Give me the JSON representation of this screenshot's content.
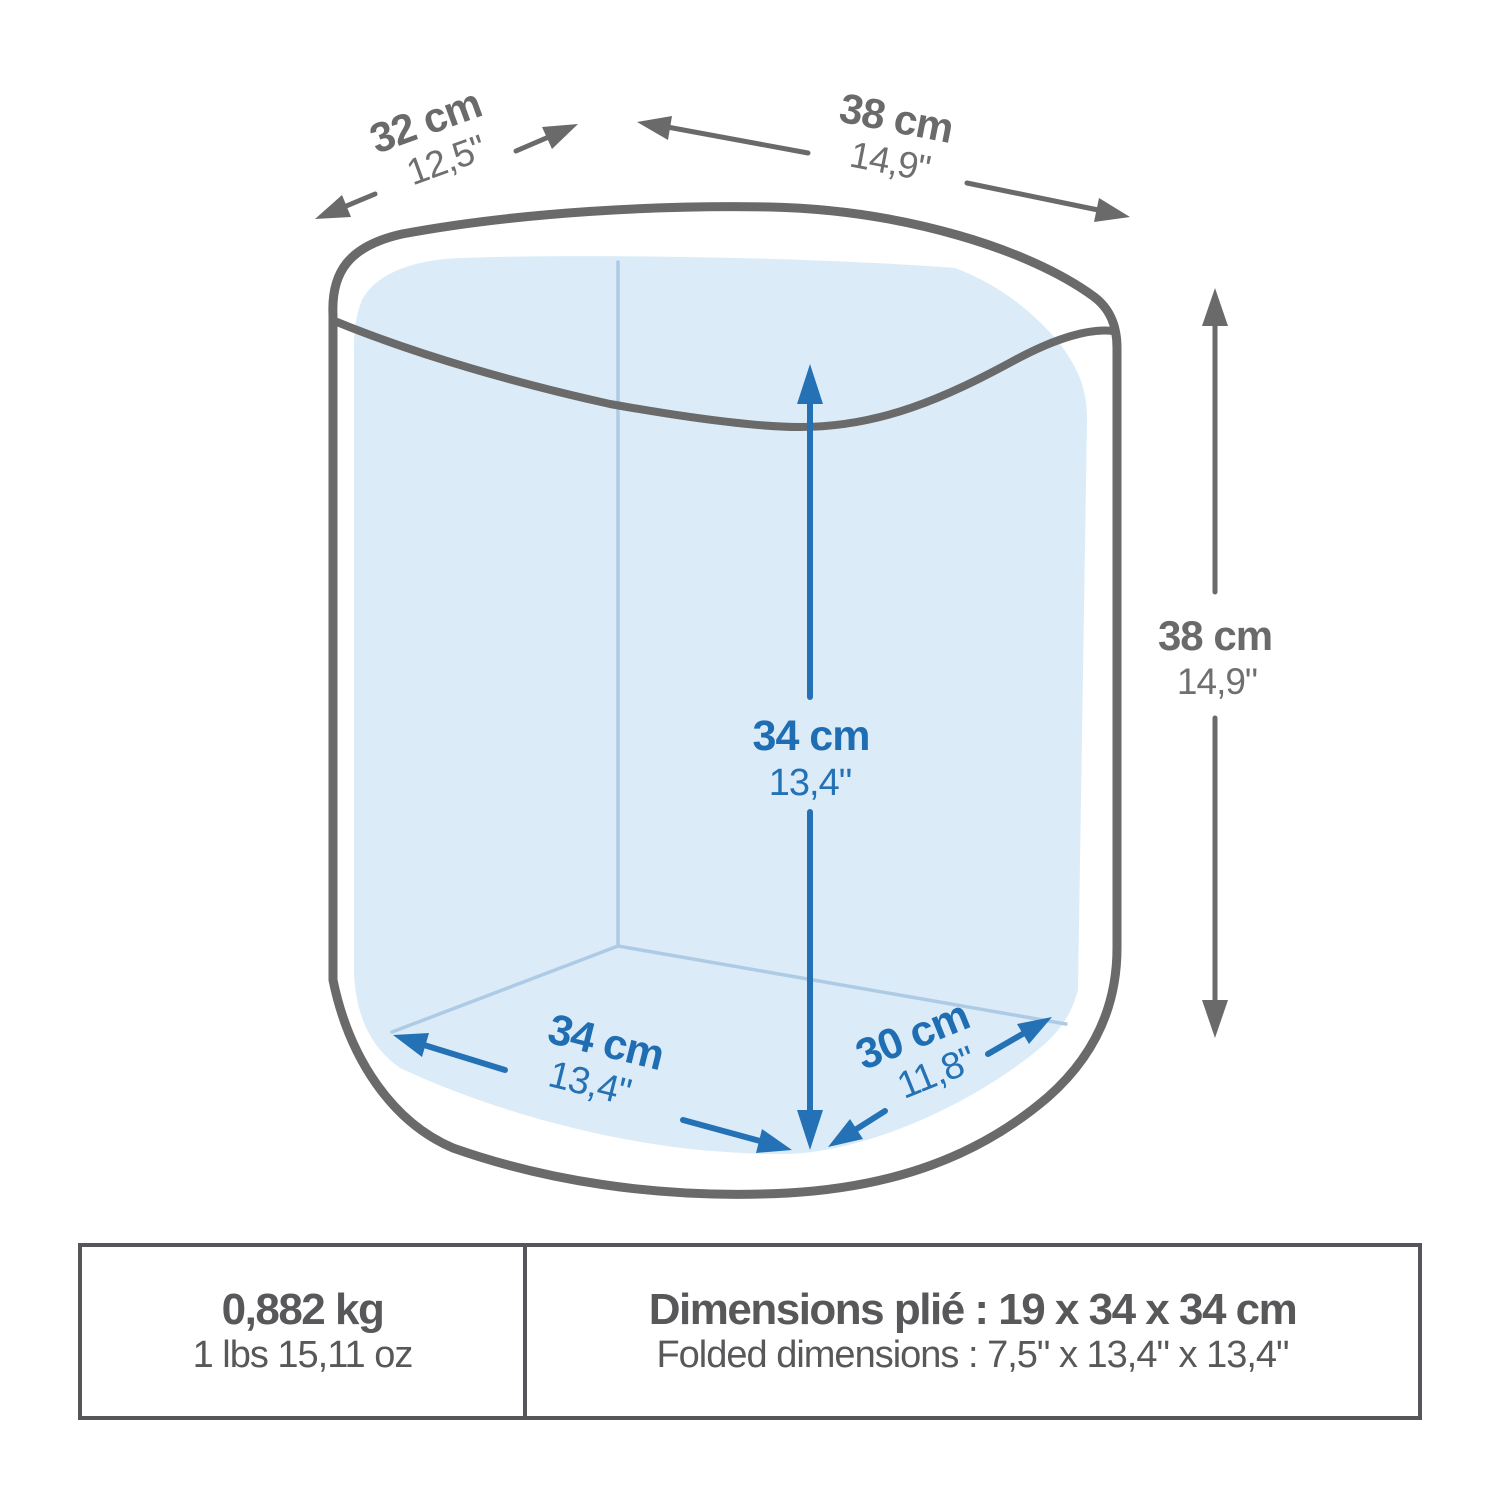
{
  "diagram": {
    "title": "container-dimensions-diagram",
    "colors": {
      "outline_gray": "#6a6a6a",
      "accent_blue": "#1f6eb3",
      "interior_fill_blue": "#dbecf8",
      "faint_edge_blue": "#aecbe6",
      "table_text_gray": "#58585a"
    },
    "labels": {
      "top_width": {
        "metric": "32 cm",
        "imperial": "12,5\""
      },
      "top_depth": {
        "metric": "38 cm",
        "imperial": "14,9\""
      },
      "height": {
        "metric": "38 cm",
        "imperial": "14,9\""
      },
      "inner_height": {
        "metric": "34 cm",
        "imperial": "13,4\""
      },
      "floor_width": {
        "metric": "34 cm",
        "imperial": "13,4\""
      },
      "floor_depth": {
        "metric": "30 cm",
        "imperial": "11,8\""
      }
    }
  },
  "spec_table": {
    "weight": {
      "primary": "0,882 kg",
      "secondary": "1 lbs 15,11 oz"
    },
    "folded_dimensions": {
      "primary": "Dimensions plié : 19 x 34 x 34 cm",
      "secondary": "Folded dimensions : 7,5\" x 13,4\" x 13,4\""
    }
  }
}
